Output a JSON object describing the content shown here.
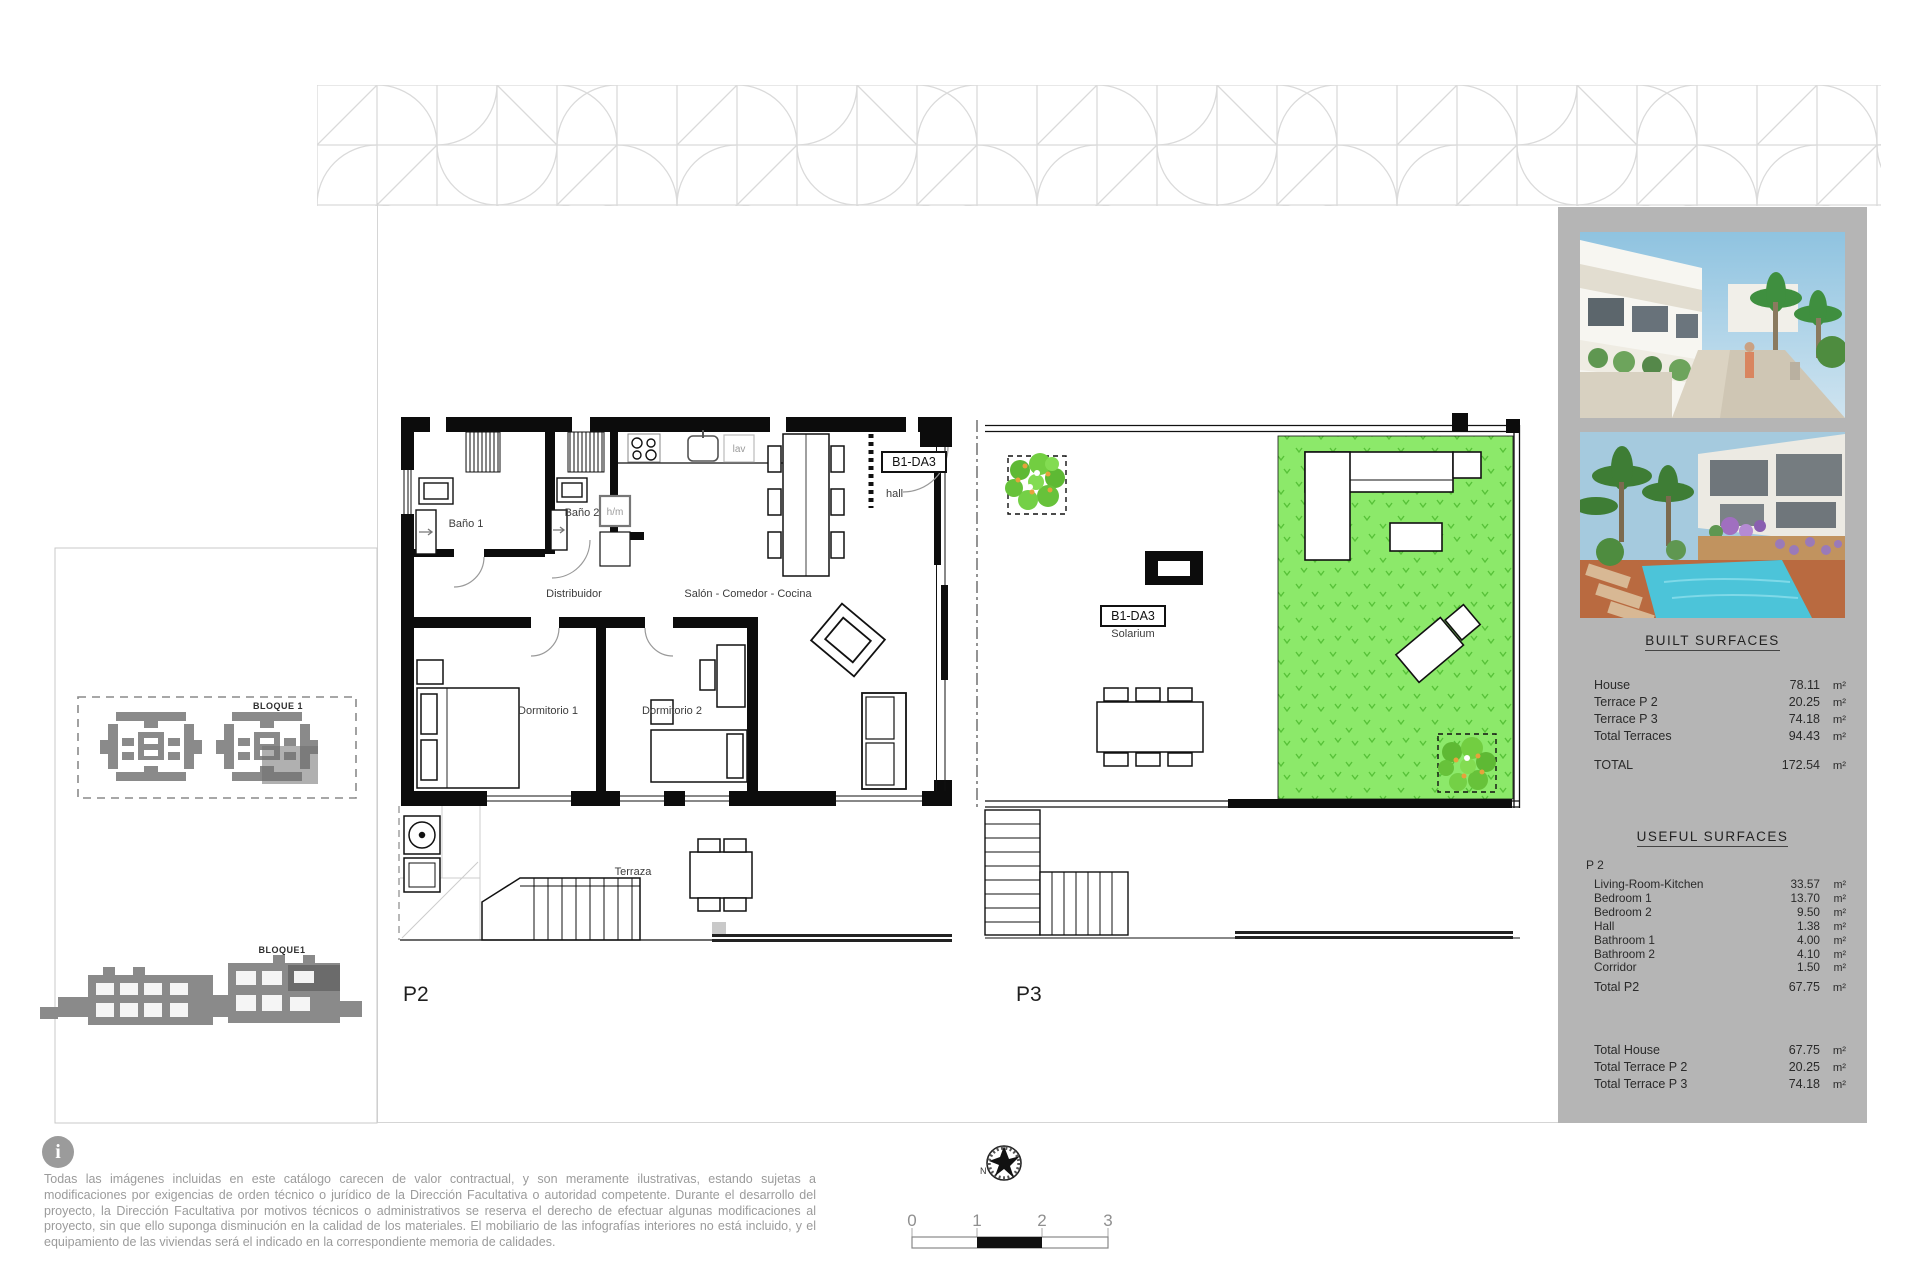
{
  "plans": {
    "p2": {
      "name": "P2",
      "unit_box": "B1-DA3",
      "rooms": {
        "bano1": "Baño 1",
        "bano2": "Baño 2",
        "distribuidor": "Distribuidor",
        "salon": "Salón - Comedor - Cocina",
        "dormitorio1": "Dormitorio 1",
        "dormitorio2": "Dormitorio 2",
        "terraza": "Terraza",
        "hall": "hall",
        "hm": "h/m",
        "lav": "lav"
      }
    },
    "p3": {
      "name": "P3",
      "unit_box": "B1-DA3",
      "rooms": {
        "solarium": "Solarium"
      }
    }
  },
  "site": {
    "bloque": "BLOQUE 1",
    "bloque_elevation": "BLOQUE1"
  },
  "surfaces": {
    "built": {
      "title": "BUILT  SURFACES",
      "rows": [
        {
          "label": "House",
          "value": "78.11",
          "unit": "m²"
        },
        {
          "label": "Terrace  P 2",
          "value": "20.25",
          "unit": "m²"
        },
        {
          "label": "Terrace  P 3",
          "value": "74.18",
          "unit": "m²"
        },
        {
          "label": "Total Terraces",
          "value": "94.43",
          "unit": "m²"
        }
      ],
      "total": {
        "label": "TOTAL",
        "value": "172.54",
        "unit": "m²"
      }
    },
    "useful": {
      "title": "USEFUL  SURFACES",
      "group": "P 2",
      "rows": [
        {
          "label": "Living-Room-Kitchen",
          "value": "33.57",
          "unit": "m²"
        },
        {
          "label": "Bedroom 1",
          "value": "13.70",
          "unit": "m²"
        },
        {
          "label": "Bedroom 2",
          "value": "9.50",
          "unit": "m²"
        },
        {
          "label": "Hall",
          "value": "1.38",
          "unit": "m²"
        },
        {
          "label": "Bathroom 1",
          "value": "4.00",
          "unit": "m²"
        },
        {
          "label": "Bathroom 2",
          "value": "4.10",
          "unit": "m²"
        },
        {
          "label": "Corridor",
          "value": "1.50",
          "unit": "m²"
        }
      ],
      "total": {
        "label": "Total  P2",
        "value": "67.75",
        "unit": "m²"
      },
      "summary": [
        {
          "label": "Total  House",
          "value": "67.75",
          "unit": "m²"
        },
        {
          "label": "Total  Terrace  P 2",
          "value": "20.25",
          "unit": "m²"
        },
        {
          "label": "Total  Terrace  P 3",
          "value": "74.18",
          "unit": "m²"
        }
      ]
    }
  },
  "footer": {
    "info_glyph": "i",
    "disclaimer": "Todas las imágenes incluidas en este catálogo carecen de valor contractual, y son meramente ilustrativas, estando sujetas a modificaciones por exigencias de orden técnico o jurídico de la Dirección Facultativa o autoridad competente. Durante el desarrollo del proyecto, la Dirección Facultativa por motivos técnicos o administrativos se reserva el derecho de efectuar algunas modificaciones al proyecto, sin que ello suponga disminución en la calidad de los materiales. El mobiliario de las infografías interiores no está incluido, y el equipamiento de las viviendas será el indicado en la correspondiente memoria de calidades.",
    "north": "N",
    "scale": [
      "0",
      "1",
      "2",
      "3"
    ]
  },
  "colors": {
    "solarium_green": "#8ce96a",
    "grass_mark_green": "#57c238",
    "sidebar_gray": "#b5b5b5",
    "pattern_gray": "#dadada",
    "siteplan_gray": "#8a8a8a",
    "text_gray": "#9b9b9b",
    "wall_black": "#0c0c0c"
  }
}
